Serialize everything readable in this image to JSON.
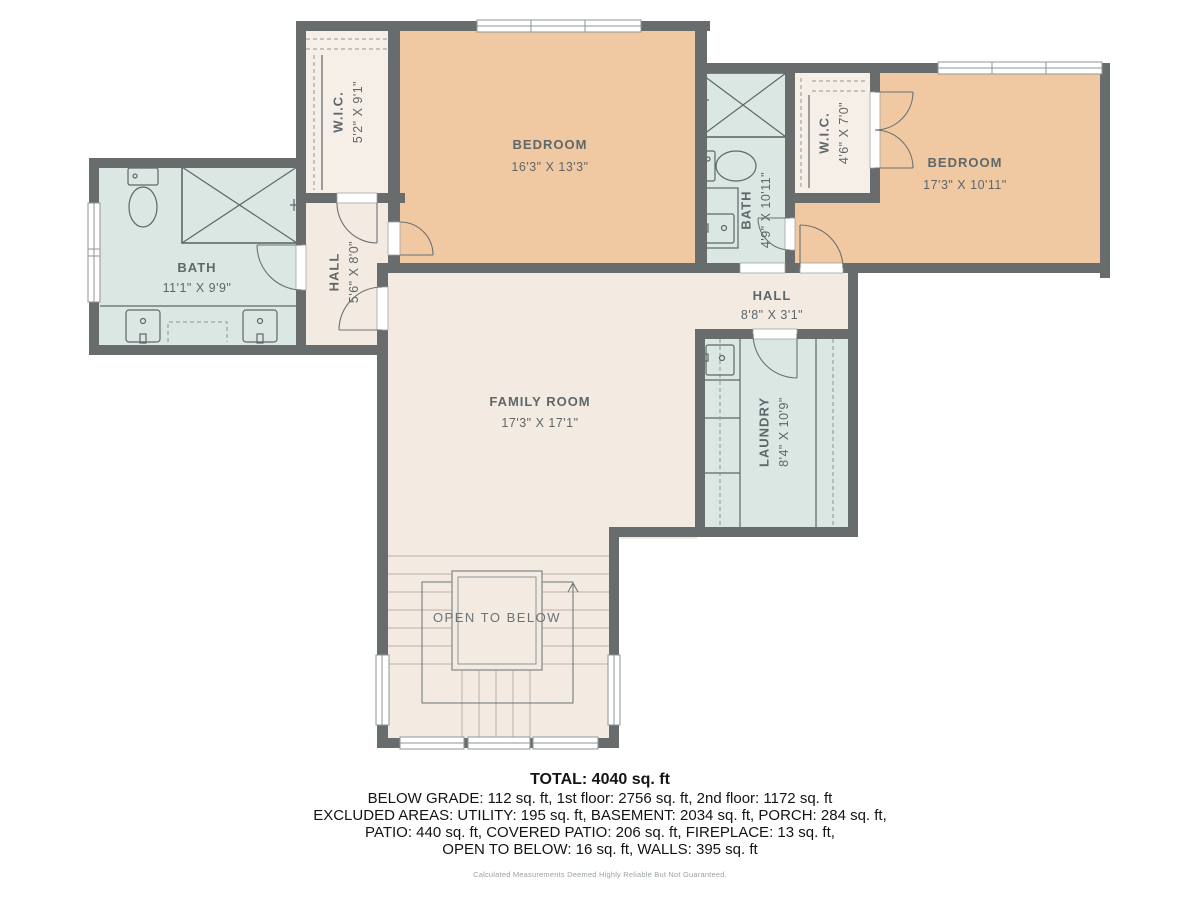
{
  "rooms": {
    "wic1": {
      "name": "W.I.C.",
      "dims": "5'2\" X 9'1\""
    },
    "bedroom1": {
      "name": "BEDROOM",
      "dims": "16'3\" X 13'3\""
    },
    "bath2": {
      "name": "BATH",
      "dims": "4'9\" X 10'11\""
    },
    "wic2": {
      "name": "W.I.C.",
      "dims": "4'6\" X 7'0\""
    },
    "bedroom2": {
      "name": "BEDROOM",
      "dims": "17'3\" X 10'11\""
    },
    "bath1": {
      "name": "BATH",
      "dims": "11'1\" X 9'9\""
    },
    "hall1": {
      "name": "HALL",
      "dims": "5'6\" X 8'0\""
    },
    "hall2": {
      "name": "HALL",
      "dims": "8'8\" X 3'1\""
    },
    "family": {
      "name": "FAMILY ROOM",
      "dims": "17'3\" X 17'1\""
    },
    "laundry": {
      "name": "LAUNDRY",
      "dims": "8'4\" X 10'9\""
    },
    "open_below": {
      "name": "OPEN TO BELOW"
    }
  },
  "summary": {
    "total": "TOTAL: 4040 sq. ft",
    "line1": "BELOW GRADE: 112 sq. ft, 1st floor: 2756 sq. ft, 2nd floor: 1172 sq. ft",
    "line2": "EXCLUDED AREAS: UTILITY: 195 sq. ft, BASEMENT: 2034 sq. ft, PORCH: 284 sq. ft,",
    "line3": "PATIO: 440 sq. ft, COVERED PATIO: 206 sq. ft, FIREPLACE: 13 sq. ft,",
    "line4": "OPEN TO BELOW: 16 sq. ft, WALLS: 395 sq. ft"
  },
  "disclaimer": "Calculated Measurements Deemed Highly Reliable But Not Guaranteed.",
  "colors": {
    "wall": "#696c6c",
    "bedroom_fill": "#f0c8a2",
    "wet_room_fill": "#dbe7e3",
    "dry_room_fill": "#f3eae2",
    "closet_fill": "#f6efe8",
    "label_text": "#5e6769",
    "summary_text": "#141414",
    "disclaimer_text": "#9aa49e"
  }
}
